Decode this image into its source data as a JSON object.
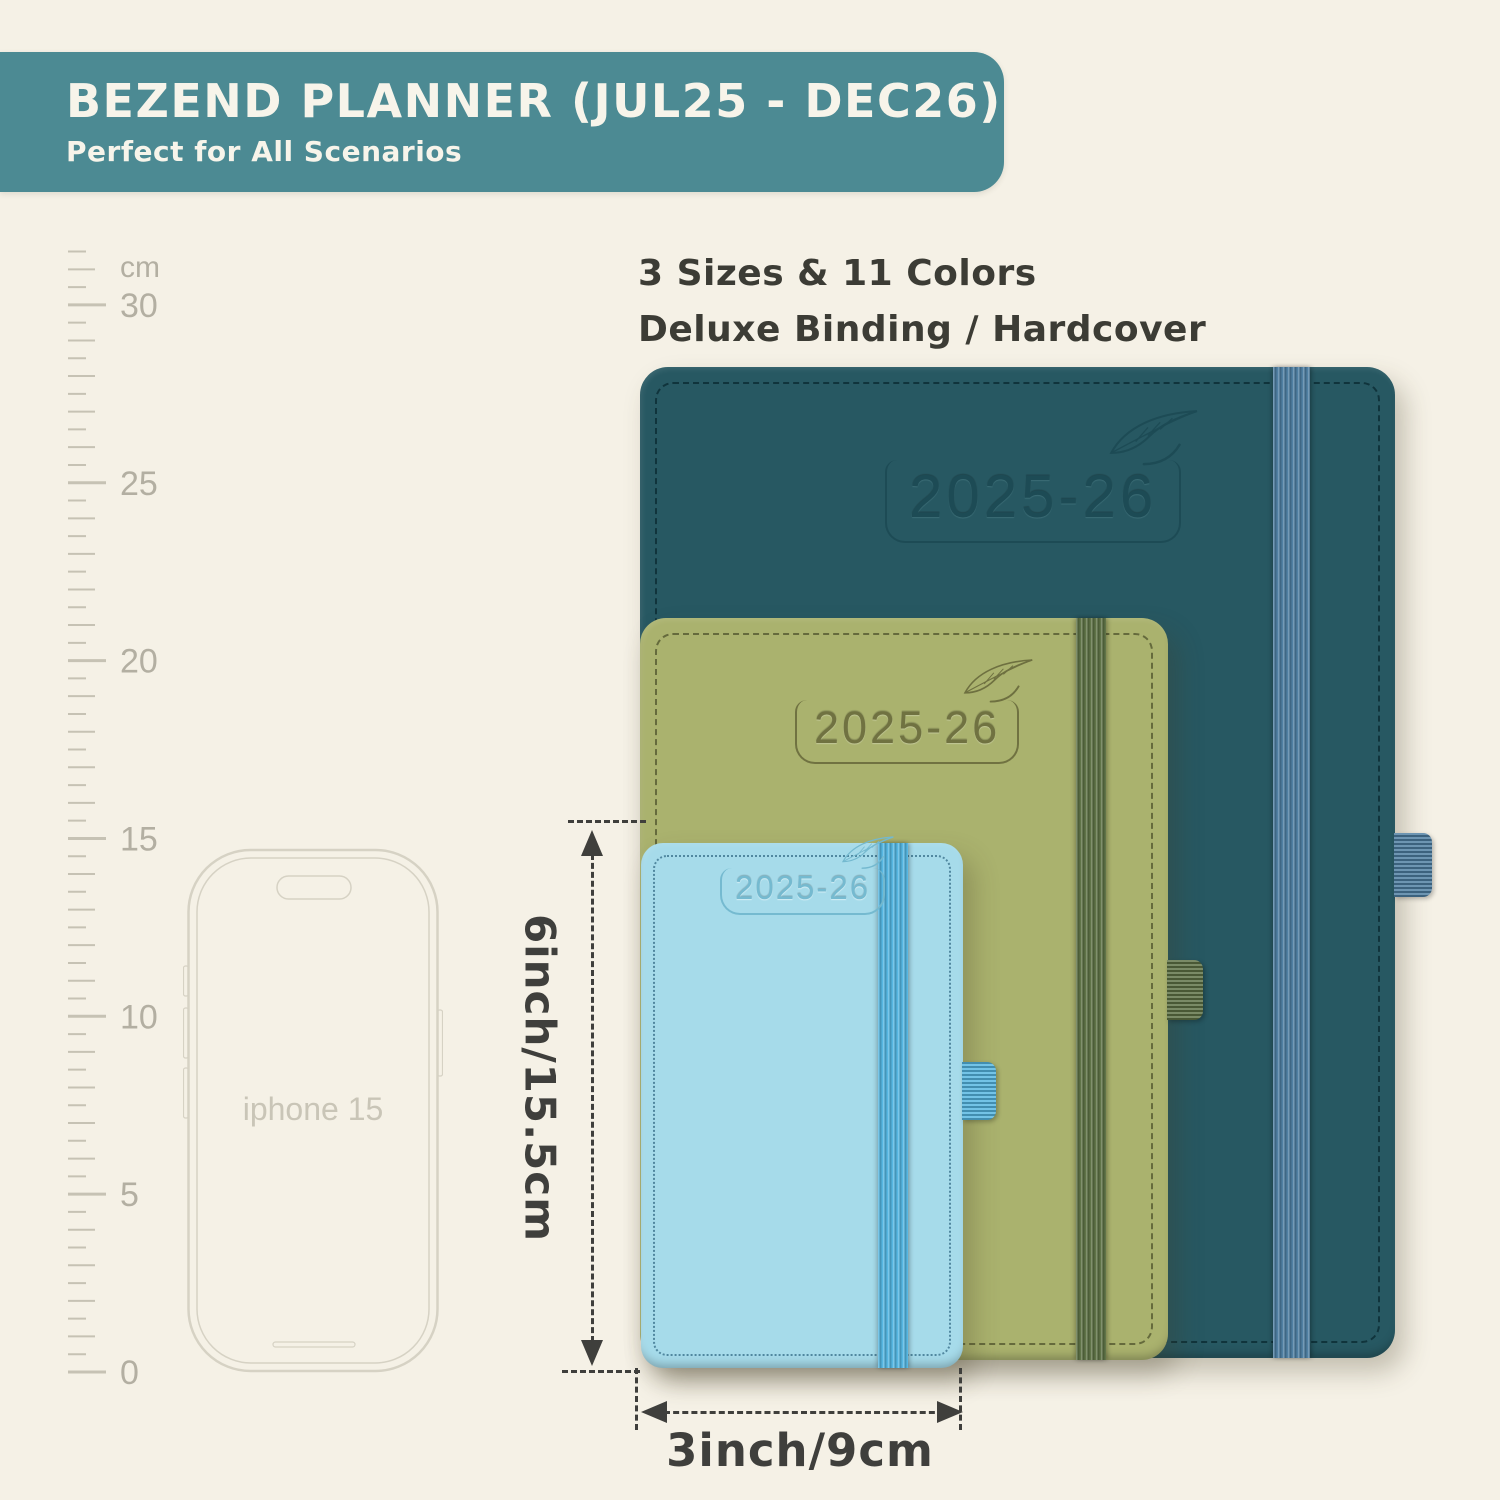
{
  "page": {
    "background": "#f5f1e6"
  },
  "banner": {
    "title": "BEZEND PLANNER (JUL25 - DEC26)",
    "subtitle": "Perfect for All Scenarios",
    "bg_color": "#4c8a93",
    "text_color": "#f7f4ea"
  },
  "subhead": {
    "line1": "3 Sizes & 11 Colors",
    "line2": "Deluxe Binding / Hardcover",
    "text_color": "#3c3c35"
  },
  "ruler": {
    "unit": "cm",
    "major_labels": [
      30,
      25,
      20,
      15,
      10,
      5,
      0
    ],
    "max_cm": 31.5,
    "px_per_cm": 35.57,
    "tick_color": "#c6c2b4",
    "label_color": "#b3afa2"
  },
  "phone": {
    "label": "iphone 15",
    "outline_color": "#d6d2c4",
    "label_color": "#c9c5b7"
  },
  "planners": [
    {
      "size": "large",
      "year": "2025-26",
      "cover_color": "#275862",
      "emboss_color": "#1d4b55",
      "emboss_highlight": "rgba(150,200,205,0.20)",
      "band_color": "#4d7ea1",
      "stitch_color": "rgba(10,40,48,0.75)"
    },
    {
      "size": "medium",
      "year": "2025-26",
      "cover_color": "#aab26e",
      "emboss_color": "#6e7040",
      "emboss_highlight": "rgba(255,255,255,0.30)",
      "band_color": "#5d7144",
      "stitch_color": "rgba(45,48,20,0.55)"
    },
    {
      "size": "small",
      "year": "2025-26",
      "cover_color": "#a6dbea",
      "emboss_color": "#74b9cf",
      "emboss_highlight": "rgba(255,255,255,0.55)",
      "band_color": "#54b6e1",
      "stitch_color": "rgba(25,80,110,0.60)"
    }
  ],
  "dimensions": {
    "height_label": "6inch/15.5cm",
    "width_label": "3inch/9cm",
    "line_color": "#3f3f3c"
  }
}
